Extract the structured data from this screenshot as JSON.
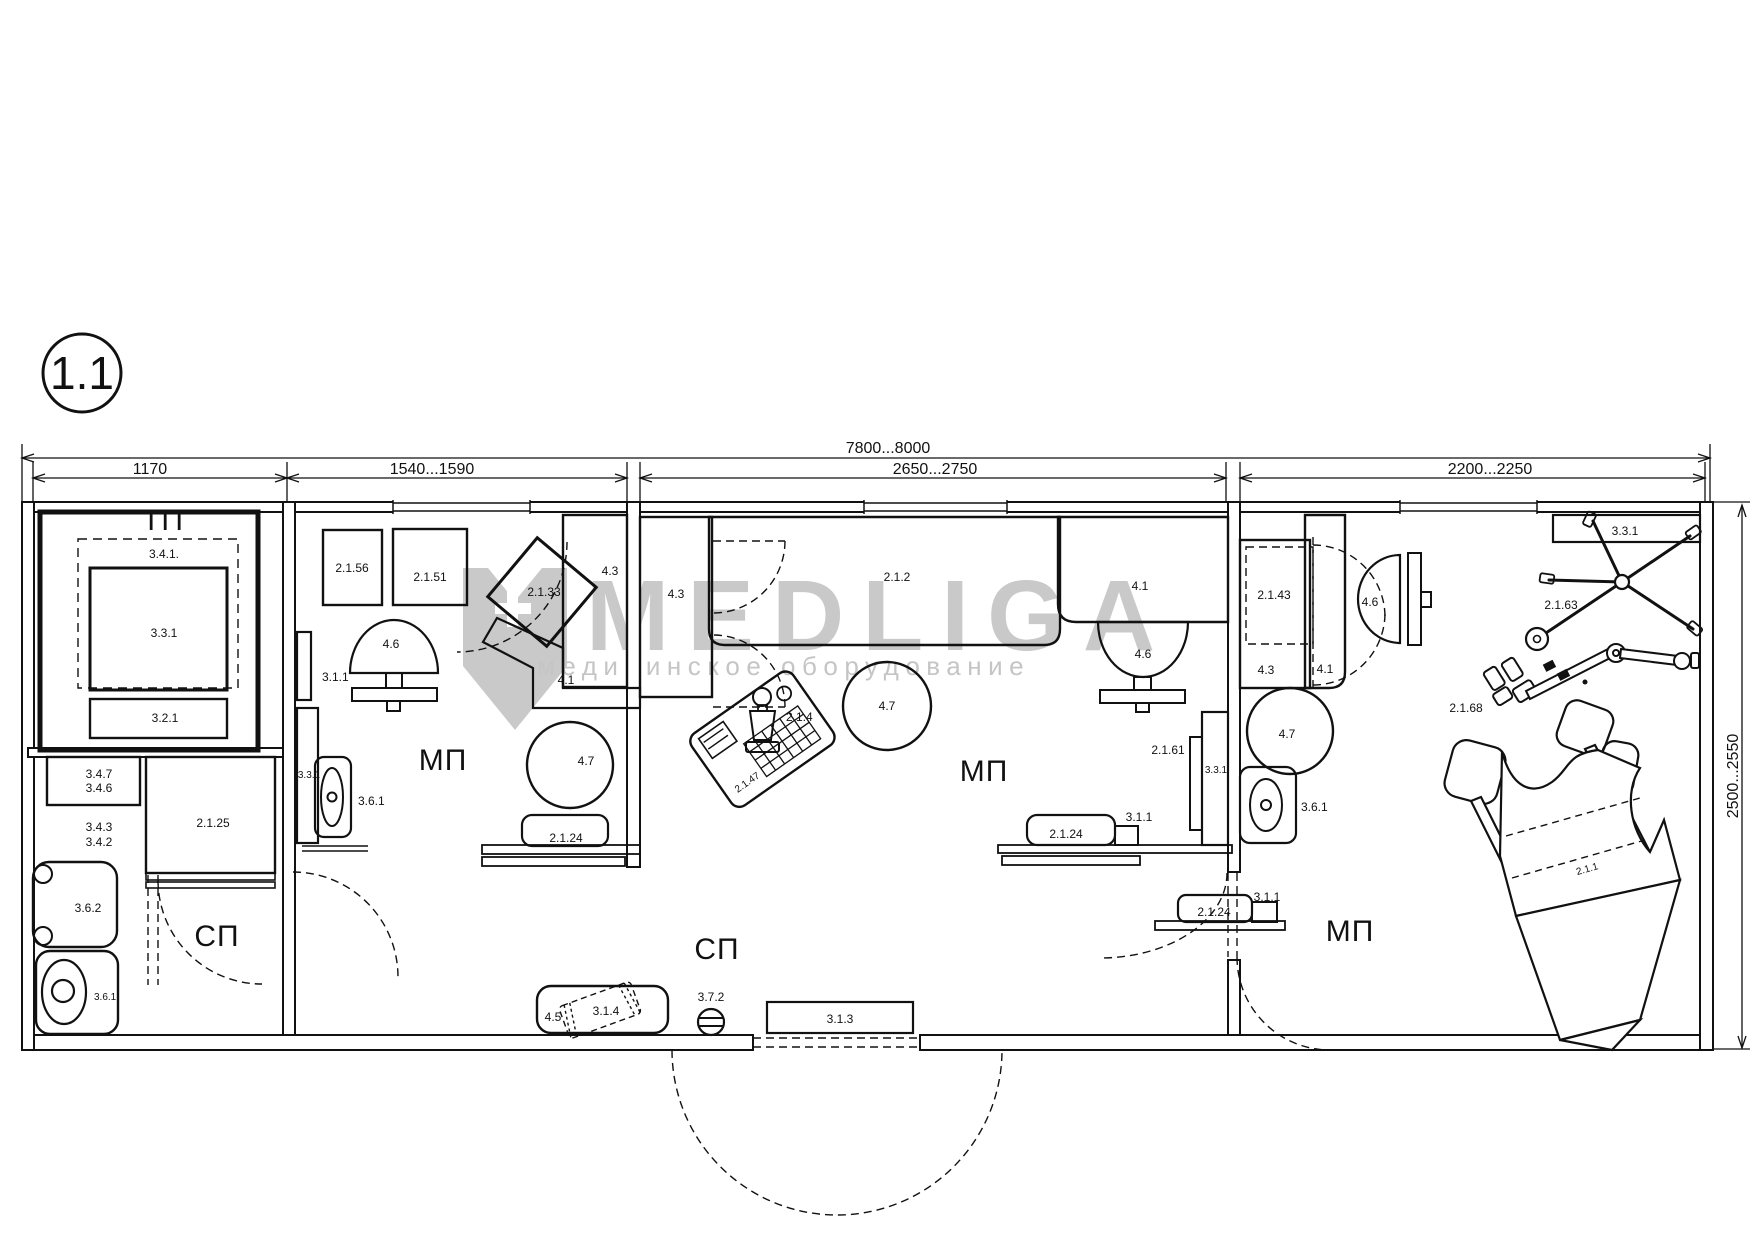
{
  "badge": {
    "label": "1.1"
  },
  "watermark": {
    "brand": "MEDLIGA",
    "tagline": "медицинское оборудование",
    "color": "#c9c9c9"
  },
  "dimensions": {
    "total": "7800...8000",
    "seg1": "1170",
    "seg2": "1540...1590",
    "seg3": "2650...2750",
    "seg4": "2200...2250",
    "right": "2500...2550"
  },
  "rooms": {
    "tp": "ТП",
    "sp1": "СП",
    "mp1": "МП",
    "mp2": "МП",
    "sp2": "СП",
    "mp3": "МП"
  },
  "labels": {
    "tp_341": "3.4.1.",
    "tp_331": "3.3.1",
    "tp_321": "3.2.1",
    "sp1_347": "3.4.7",
    "sp1_346": "3.4.6",
    "sp1_343": "3.4.3",
    "sp1_342": "3.4.2",
    "sp1_2125": "2.1.25",
    "sp1_362": "3.6.2",
    "sp1_361": "3.6.1",
    "mp1_2156": "2.1.56",
    "mp1_2151": "2.1.51",
    "mp1_2133": "2.1.33",
    "mp1_43": "4.3",
    "mp1_46": "4.6",
    "mp1_311": "3.1.1",
    "mp1_331": "3.3.1",
    "mp1_361": "3.6.1",
    "mp1_47": "4.7",
    "mp1_41": "4.1",
    "mp1_2124": "2.1.24",
    "mp2_43": "4.3",
    "mp2_212": "2.1.2",
    "mp2_41": "4.1",
    "mp2_46": "4.6",
    "mp2_47": "4.7",
    "mp2_2147": "2.1.47",
    "mp2_214": "2.1.4",
    "mp2_2161": "2.1.61",
    "mp2_331": "3.3.1",
    "mp2_2124": "2.1.24",
    "mp2_311": "3.1.1",
    "sp2_45": "4.5",
    "sp2_314": "3.1.4",
    "sp2_372": "3.7.2",
    "sp2_313": "3.1.3",
    "mp3_2143": "2.1.43",
    "mp3_43": "4.3",
    "mp3_41": "4.1",
    "mp3_46": "4.6",
    "mp3_331": "3.3.1",
    "mp3_2163": "2.1.63",
    "mp3_2168": "2.1.68",
    "mp3_47": "4.7",
    "mp3_361": "3.6.1",
    "mp3_2124": "2.1.24",
    "mp3_311": "3.1.1",
    "mp3_211": "2.1.1"
  }
}
